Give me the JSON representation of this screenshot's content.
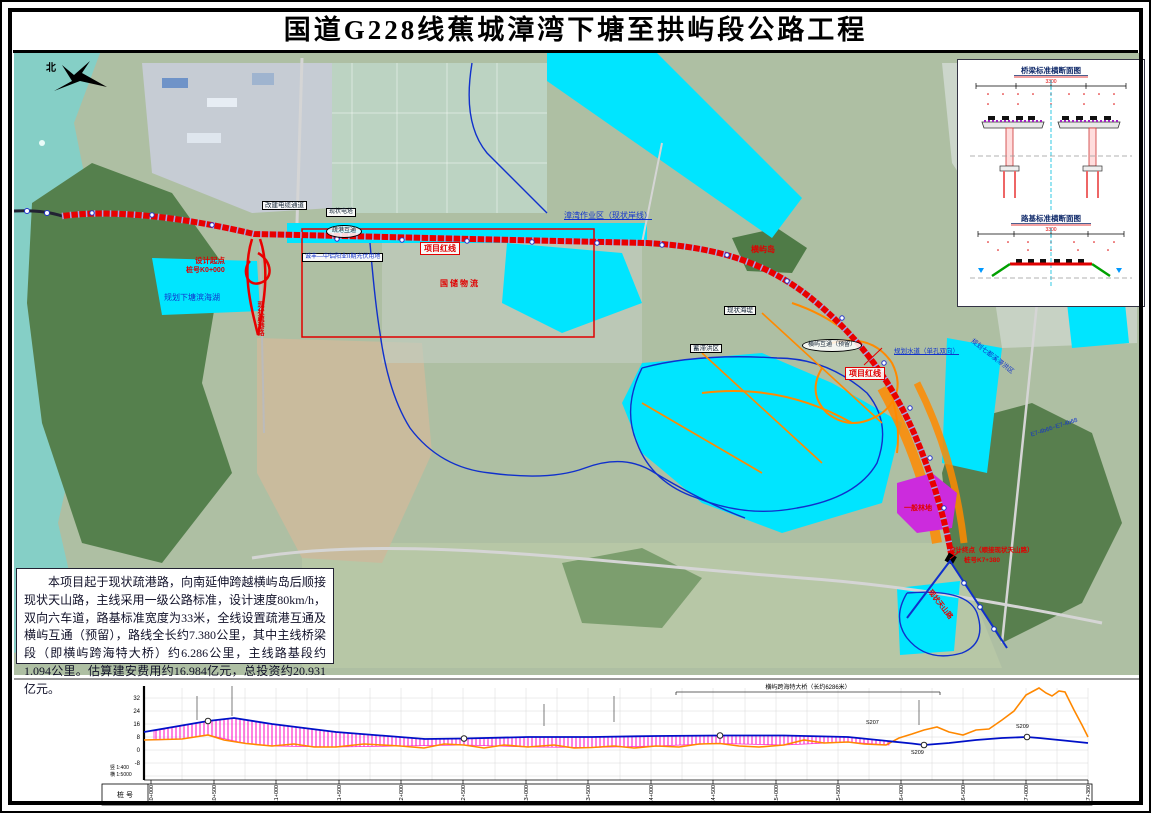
{
  "title": "国道G228线蕉城漳湾下塘至拱屿段公路工程",
  "description": "本项目起于现状疏港路，向南延伸跨越横屿岛后顺接现状天山路，主线采用一级公路标准，设计速度80km/h，双向六车道，路基标准宽度为33米，全线设置疏港互通及横屿互通（预留），路线全长约7.380公里，其中主线桥梁段（即横屿跨海特大桥）约6.286公里，主线路基段约1.094公里。估算建安费用约16.984亿元，总投资约20.931亿元。",
  "compass_label": "北",
  "map_labels": {
    "project_redline": "项目红线",
    "project_redline2": "项目红线",
    "design_start": "设计起点",
    "start_station": "桩号K0+000",
    "design_end": "设计终点（顺接现状天山路）",
    "end_station": "桩号K7+380",
    "planned_lake": "规划下塘滨海湖",
    "zhangwan_port": "漳湾作业区（现状岸线）",
    "hengyu_island": "横屿岛",
    "existing_seawall": "现状海堤",
    "flood_area": "蓄滞洪区",
    "planned_channel": "规划水道（单孔双向）",
    "qidu_area": "规划七都溪滞洪区",
    "shugang_ic": "疏港互通",
    "hengyu_ic": "横屿互通（预留）",
    "shugang_road": "现状疏港路",
    "tianshan_road": "现状天山路",
    "forest_land": "一般林地",
    "pv_land": "诚丰—中铝阳业II期光伏用地",
    "logistics": "国储物流",
    "cable_channel": "改建电缆通道",
    "power_tower": "现状电塔",
    "bridge_code": "E7-4b66~E7-4b68"
  },
  "cross_sections": {
    "bridge_title": "桥梁标准横断面图",
    "bridge_width": "3300",
    "subgrade_title": "路基标准横断面图",
    "subgrade_width": "3300"
  },
  "profile": {
    "row_label": "桩  号",
    "scale_v": "竖 1:400",
    "scale_h": "横 1:5000",
    "annotation": "横屿跨海特大桥（长约6286米）",
    "y_ticks": [
      "32",
      "24",
      "16",
      "8",
      "0",
      "-8"
    ],
    "curve_point_1": "S207",
    "curve_point_2": "S209",
    "stations": [
      "K0+000",
      "K0+500",
      "K1+000",
      "K1+500",
      "K2+000",
      "K2+500",
      "K3+000",
      "K3+500",
      "K4+000",
      "K4+500",
      "K5+000",
      "K5+500",
      "K6+000",
      "K6+500",
      "K7+000",
      "K7+380"
    ]
  },
  "chart_data": {
    "type": "line",
    "title": "主线纵断面示意",
    "xlabel": "桩号(km)",
    "ylabel": "高程(m)",
    "ylim": [
      -8,
      40
    ],
    "legend_position": "none",
    "grid": true,
    "series": [
      {
        "name": "设计线",
        "x": [
          0,
          0.5,
          0.7,
          1,
          1.5,
          2,
          2.2,
          2.5,
          3,
          3.5,
          4,
          4.5,
          5,
          5.5,
          6,
          6.1,
          6.5,
          6.9,
          7,
          7.38
        ],
        "values": [
          11,
          18,
          20,
          16,
          11,
          8,
          6.5,
          7,
          8,
          8,
          8.5,
          9,
          9,
          8,
          4,
          3,
          6,
          8,
          7.5,
          4.5
        ]
      },
      {
        "name": "地面线",
        "x": [
          0,
          0.3,
          0.5,
          0.8,
          1,
          1.5,
          2,
          2.5,
          3,
          3.5,
          4,
          4.5,
          5,
          5.5,
          5.8,
          6,
          6.2,
          6.4,
          6.6,
          6.8,
          7,
          7.1,
          7.2,
          7.38
        ],
        "values": [
          6,
          7,
          9,
          4,
          2.5,
          2,
          2.5,
          3,
          2,
          1.5,
          2.5,
          4,
          3,
          5,
          3,
          10,
          14,
          9,
          13,
          24,
          38,
          33,
          36,
          8
        ]
      }
    ],
    "bridge_span_km": [
      0.1,
      6.15
    ]
  },
  "colors": {
    "route_red": "#e80000",
    "water_cyan": "#00e5ff",
    "boundary_blue": "#1030cc",
    "planned_orange": "#ff8a00",
    "profile_design": "#0010c8",
    "profile_ground": "#ff8800",
    "bridge_hatch": "#ff2dcb",
    "forest_purple": "#cc2bdd"
  }
}
